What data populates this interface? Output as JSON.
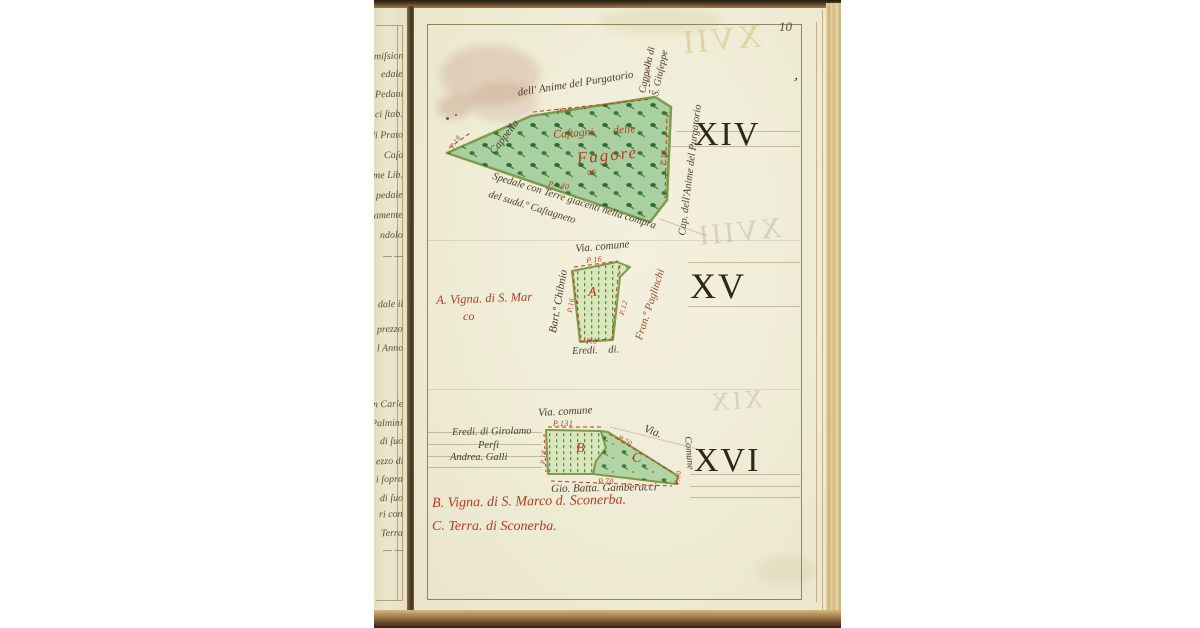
{
  "page": {
    "number": "10",
    "numeral_xiv": "XIV",
    "numeral_xv": "XV",
    "numeral_xvi": "XVI",
    "bleedthrough_top": "XVII",
    "bleedthrough_middle": "XVIII",
    "bleedthrough_bottom": "XIX",
    "ink_mark": "’"
  },
  "plot_xiv": {
    "top_edge_label": "dell' Anime del Purgatorio",
    "left_edge_label": "Cappella",
    "corner_label_line1": "Cappella di",
    "corner_label_line2": "S. Giuſeppe",
    "right_edge_label": "Cap. dell'Anime del Purgatorio",
    "bottom_label_line1": "Spedale con Terre giacenti nella compra",
    "bottom_label_line2": "del sudd.º Caſtagneto",
    "inner_label_line1": "Caſtagni. delle",
    "inner_label_line2": "Fagore",
    "inner_flourish": "∞",
    "measure_top": "P.19",
    "measure_bottom": "P.º 40",
    "measure_right": "P.14",
    "measure_left": "P.18"
  },
  "plot_xv": {
    "road_label": "Via. comune",
    "owner_left": "Bart.º Chibnio",
    "owner_right": "Fran.º Paglinchi",
    "owner_bottom": "Eredi. di.",
    "parcel_letter": "A",
    "caption_line1": "A. Vigna. di S. Mar",
    "caption_line2": "co",
    "measure_top": "P.16",
    "measure_left": "P.16",
    "measure_right": "P.12",
    "measure_bottom": "P.9"
  },
  "plot_xvi": {
    "road_label_top": "Via. comune",
    "road_label_right1": "Via.",
    "road_label_right2": "Comune",
    "owner_left_line1": "Eredi. di Girolamo",
    "owner_left_line2": "Perſi",
    "owner_left_line3": "Andrea. Galli",
    "owner_bottom": "Gio. Batta. Gamberucci",
    "parcel_letter_b": "B",
    "parcel_letter_c": "C",
    "caption_b": "B. Vigna. di S. Marco d. Sconerba.",
    "caption_c": "C. Terra. di Sconerba.",
    "measure_top": "P.131",
    "measure_slant": "P.70",
    "measure_bottom": "P.70",
    "measure_left": "P.18",
    "measure_right": "P.30"
  },
  "left_strip": {
    "fragments": [
      "miſsion",
      "edale",
      "Pedani",
      "ci ſtab.",
      "di Prato",
      "Caſa",
      "me Lib.",
      "pedale",
      "lamente",
      "ndolo",
      "— —",
      "dale il",
      "prezzo",
      "l Anno",
      "n Carle",
      "Palmini",
      "di ſuo",
      "ezzo di",
      "i ſopra",
      "di ſuo",
      "ri con",
      "Terra",
      "— —"
    ]
  },
  "colors": {
    "red_ink": "#b43c22",
    "black_ink": "#473e2c",
    "plot_green": "#a9d0a0",
    "vineyard_green": "#d9e7bc",
    "page_cream": "#f0edd8"
  }
}
